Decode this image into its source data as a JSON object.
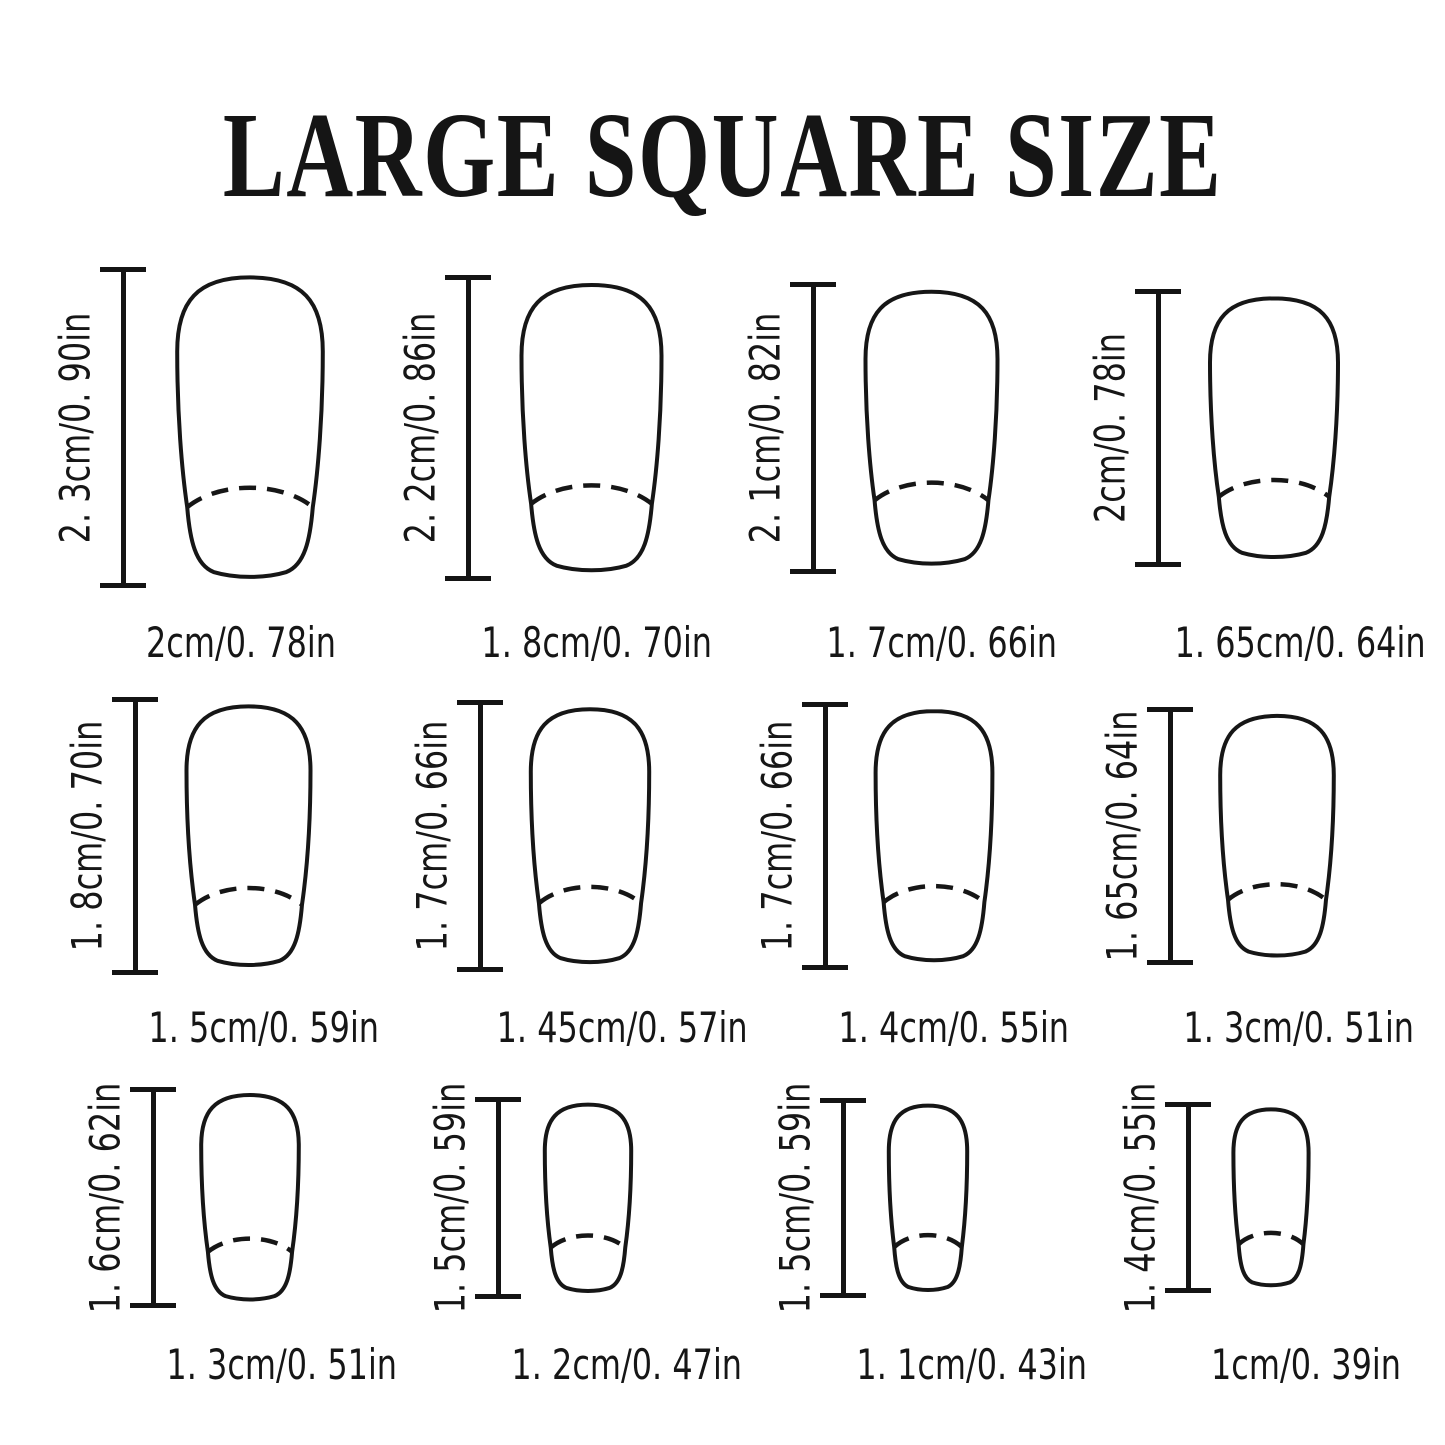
{
  "title": "LARGE SQUARE SIZE",
  "colors": {
    "line": "#161616",
    "background": "#ffffff"
  },
  "nails": [
    {
      "height": "2. 3cm/0. 90in",
      "width": "2cm/0. 78in"
    },
    {
      "height": "2. 2cm/0. 86in",
      "width": "1. 8cm/0. 70in"
    },
    {
      "height": "2. 1cm/0. 82in",
      "width": "1. 7cm/0. 66in"
    },
    {
      "height": "2cm/0. 78in",
      "width": "1. 65cm/0. 64in"
    },
    {
      "height": "1. 8cm/0. 70in",
      "width": "1. 5cm/0. 59in"
    },
    {
      "height": "1. 7cm/0. 66in",
      "width": "1. 45cm/0. 57in"
    },
    {
      "height": "1. 7cm/0. 66in",
      "width": "1. 4cm/0. 55in"
    },
    {
      "height": "1. 65cm/0. 64in",
      "width": "1. 3cm/0. 51in"
    },
    {
      "height": "1. 6cm/0. 62in",
      "width": "1. 3cm/0. 51in"
    },
    {
      "height": "1. 5cm/0. 59in",
      "width": "1. 2cm/0. 47in"
    },
    {
      "height": "1. 5cm/0. 59in",
      "width": "1. 1cm/0. 43in"
    },
    {
      "height": "1. 4cm/0. 55in",
      "width": "1cm/0. 39in"
    }
  ]
}
